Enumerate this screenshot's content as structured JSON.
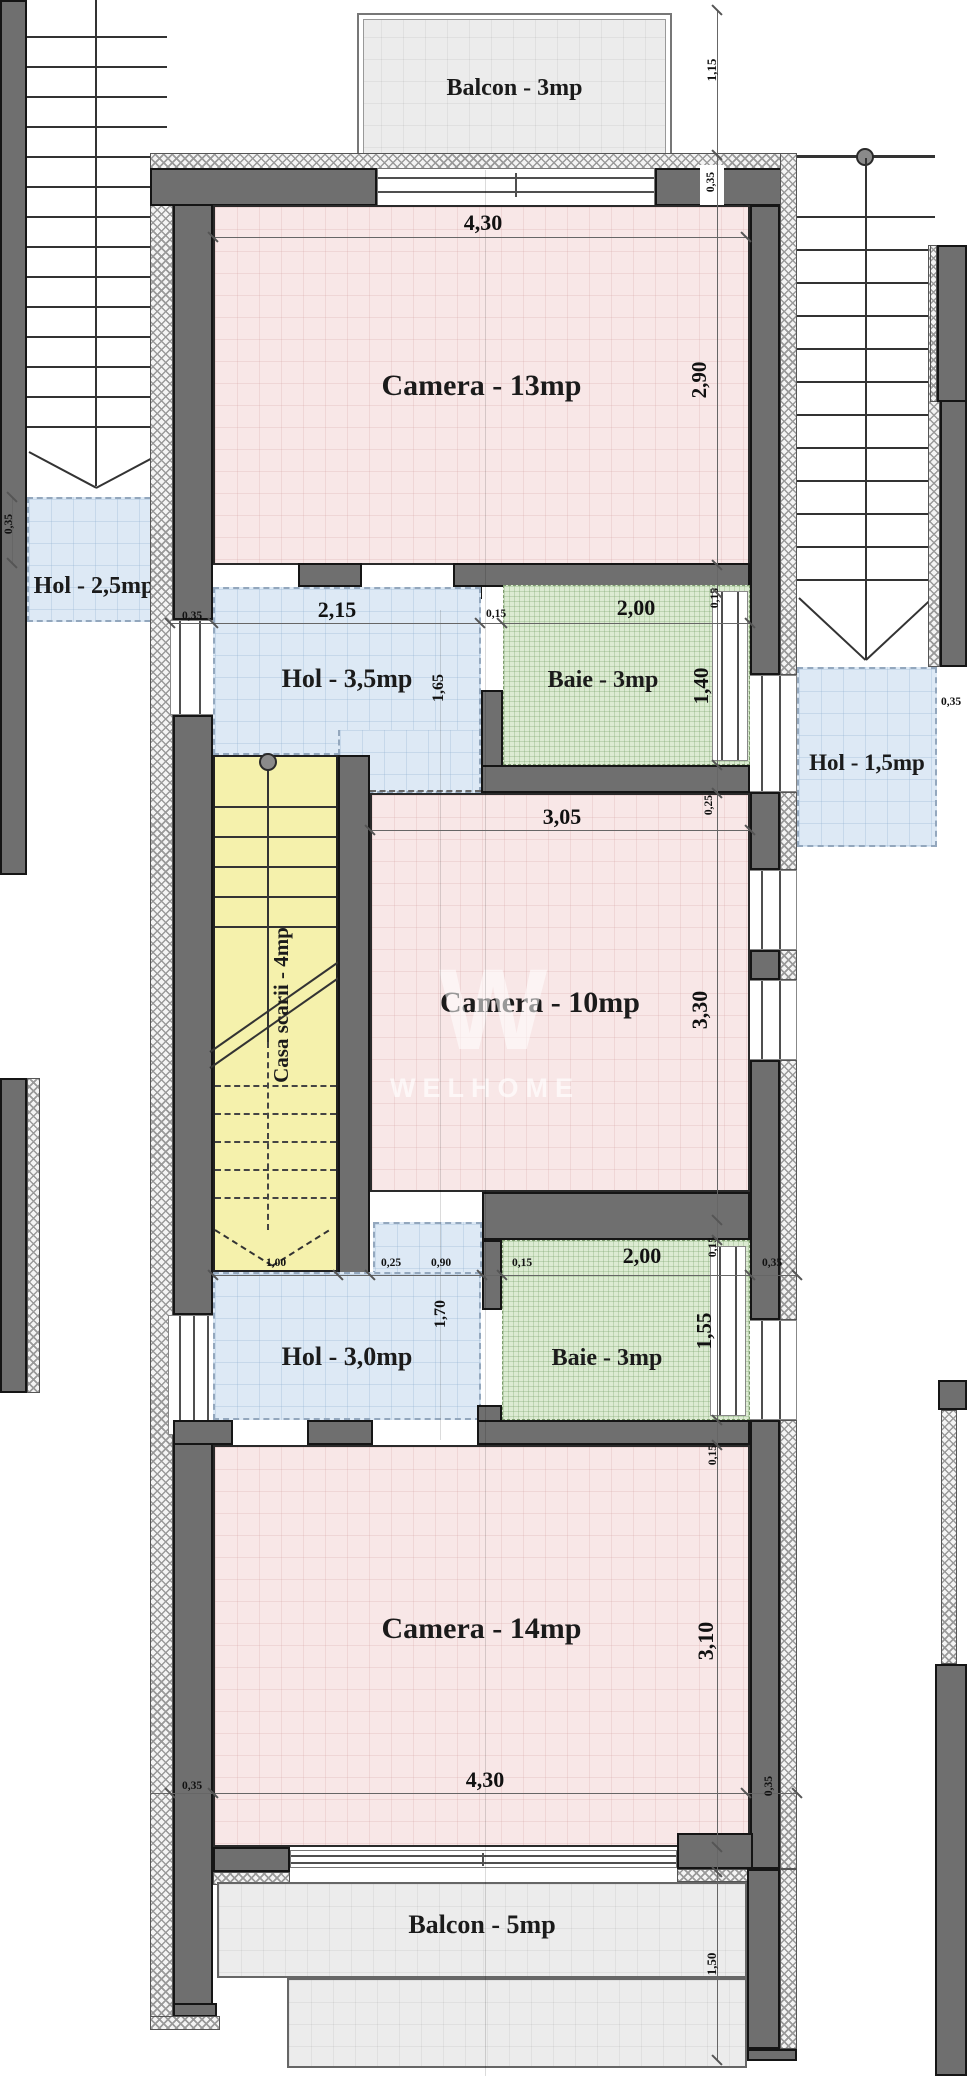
{
  "watermark": {
    "logo_glyph": "W",
    "text": "WELHOME"
  },
  "rooms": {
    "balcon_top": {
      "label": "Balcon - 3mp"
    },
    "camera_13": {
      "label": "Camera - 13mp"
    },
    "hol_25": {
      "label": "Hol - 2,5mp"
    },
    "hol_35": {
      "label": "Hol - 3,5mp"
    },
    "baie_sus": {
      "label": "Baie - 3mp"
    },
    "hol_15": {
      "label": "Hol - 1,5mp"
    },
    "camera_10": {
      "label": "Camera - 10mp"
    },
    "casa_scarii": {
      "label": "Casa scarii - 4mp"
    },
    "hol_30": {
      "label": "Hol - 3,0mp"
    },
    "baie_jos": {
      "label": "Baie - 3mp"
    },
    "camera_14": {
      "label": "Camera - 14mp"
    },
    "balcon_bottom": {
      "label": "Balcon - 5mp"
    }
  },
  "dimensions": {
    "balcon_top_depth": "1,15",
    "camera13_width": "4,30",
    "camera13_height": "2,90",
    "wall_top_right": "0,35",
    "hol25_wall": "0,35",
    "row_sus": {
      "left_wall": "0,35",
      "opening": "2,15",
      "pier": "0,15",
      "baie_width": "2,00",
      "wall_v": "0,15"
    },
    "hol35_height": "1,65",
    "baie_sus_height": "1,40",
    "baie_sus_wall": "0,25",
    "hol15_wall": "0,35",
    "camera10_width": "3,05",
    "camera10_height": "3,30",
    "row_jos": {
      "scara_width": "1,00",
      "wall": "0,25",
      "opening": "0,90",
      "pier": "0,15",
      "baie_width": "2,00",
      "wall_v": "0,15",
      "right_wall": "0,35"
    },
    "hol30_height": "1,70",
    "baie_jos_height": "1,55",
    "baie_jos_wall": "0,15",
    "camera14_height": "3,10",
    "camera14_width": "4,30",
    "wall_bottom_left": "0,35",
    "wall_bottom_right": "0,35",
    "balcon_bottom_depth": "1,50"
  },
  "colors": {
    "room_fill": "#f8e7e7",
    "hall_fill": "#dde9f5",
    "bath_fill": "#dcebd2",
    "stair_fill": "#f5f1ac",
    "balcony_fill": "#ececec",
    "wall_fill": "#6f6f6f"
  }
}
